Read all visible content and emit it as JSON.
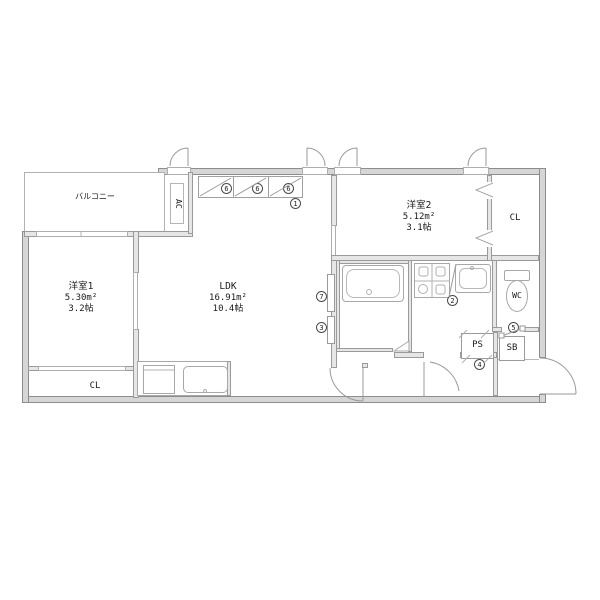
{
  "plan_title": "apartment-floor-plan",
  "colors": {
    "background": "#ffffff",
    "wall_line": "#8d8d8d",
    "wall_fill": "#d6d6d6",
    "interior_wall_fill": "#e6e6e6",
    "fixture_line": "#a8a8a8",
    "text": "#1a1a1a"
  },
  "rooms": {
    "balcony": {
      "label": "バルコニー"
    },
    "room1": {
      "label": "洋室1",
      "area_m2": "5.30m²",
      "area_jo": "3.2帖"
    },
    "ldk": {
      "label": "LDK",
      "area_m2": "16.91m²",
      "area_jo": "10.4帖"
    },
    "room2": {
      "label": "洋室2",
      "area_m2": "5.12m²",
      "area_jo": "3.1帖"
    },
    "closet1": {
      "label": "CL"
    },
    "closet2": {
      "label": "CL"
    },
    "wc": {
      "label": "WC"
    },
    "ps": {
      "label": "PS"
    },
    "sb": {
      "label": "SB"
    },
    "ac": {
      "label": "AC"
    }
  },
  "markers": {
    "n1": "1",
    "n2": "2",
    "n3": "3",
    "n4": "4",
    "n5": "5",
    "n6": "6",
    "n7": "7"
  }
}
